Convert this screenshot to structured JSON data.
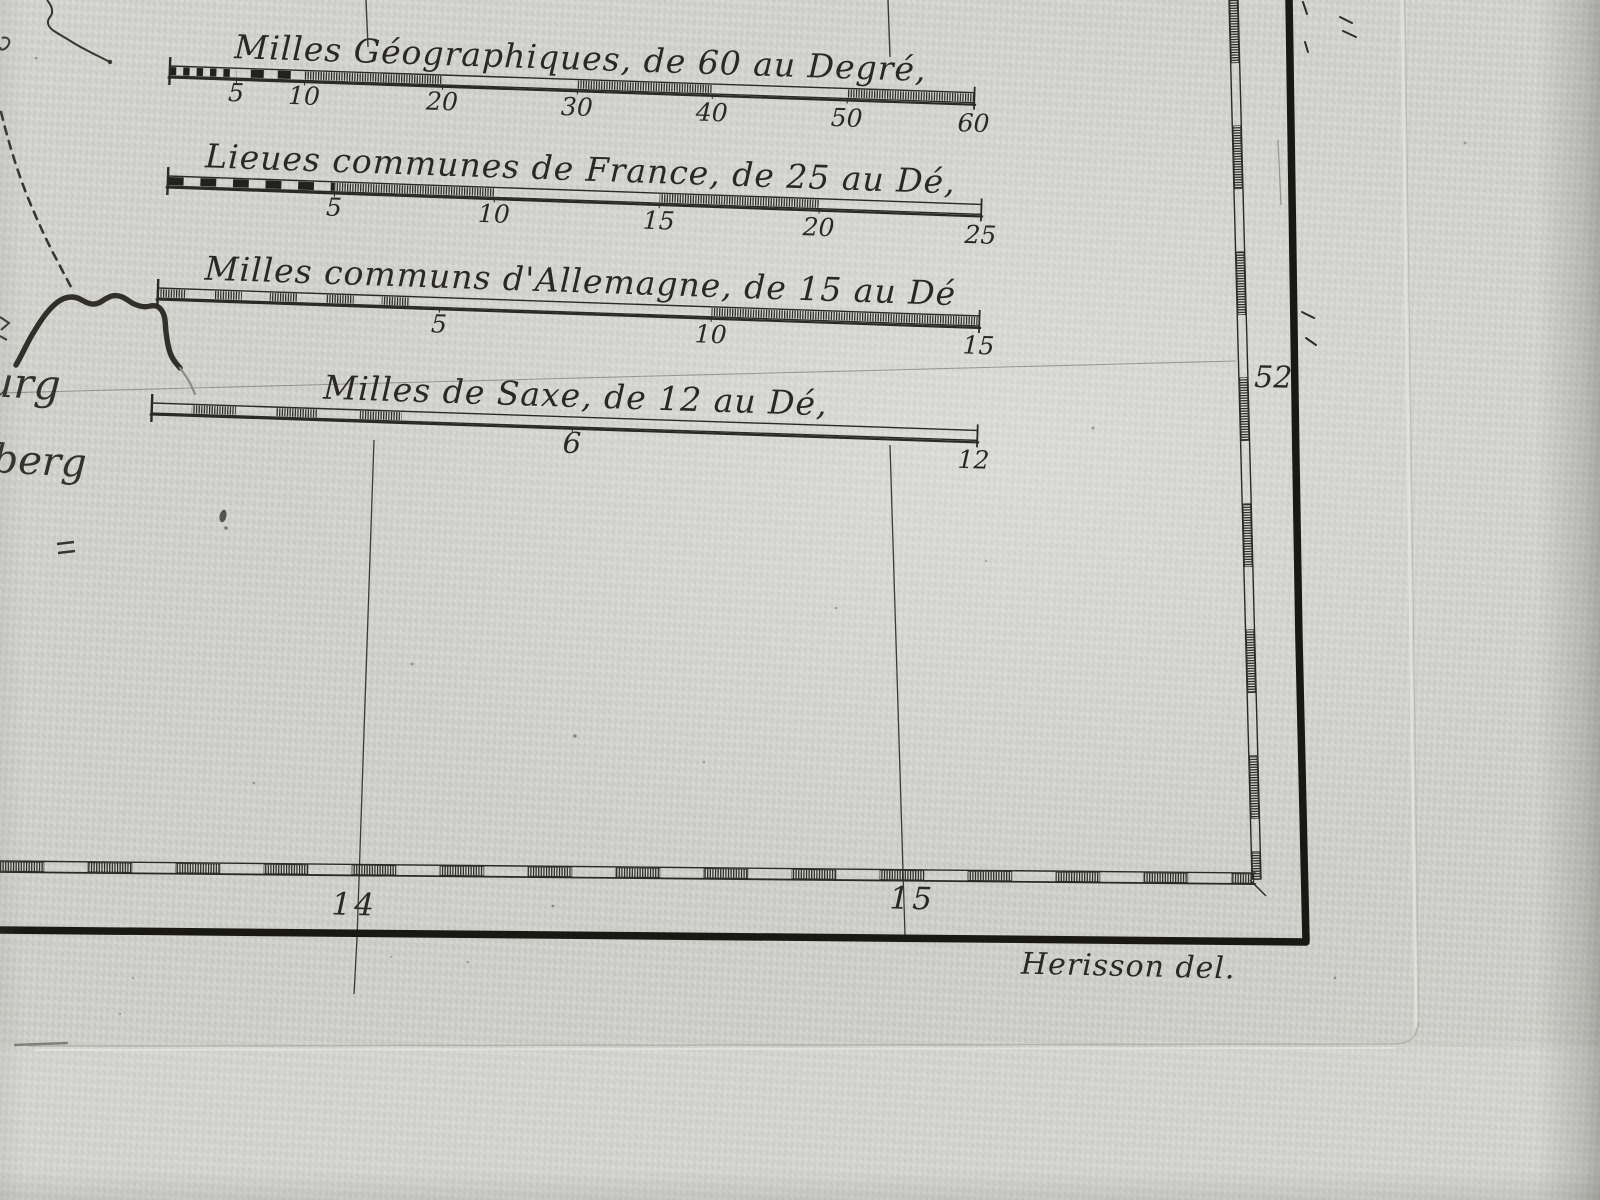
{
  "scale_bars": [
    {
      "title": "Milles Géographiques, de 60 au Degré,",
      "ticks": [
        "5",
        "10",
        "20",
        "30",
        "40",
        "50",
        "60"
      ]
    },
    {
      "title": "Lieues communes de France, de 25 au Dé,",
      "ticks": [
        "5",
        "10",
        "15",
        "20",
        "25"
      ]
    },
    {
      "title": "Milles communs d'Allemagne, de 15 au Dé",
      "ticks": [
        "5",
        "10",
        "15"
      ]
    },
    {
      "title": "Milles de Saxe, de 12 au Dé,",
      "ticks": [
        "6",
        "12"
      ]
    }
  ],
  "graticule": {
    "latitude_label": "52",
    "longitude_labels": [
      "14",
      "15"
    ]
  },
  "place_names": {
    "fragment_1": "urg",
    "fragment_2": "berg"
  },
  "signature": "Herisson del.",
  "colors": {
    "paper": "#d3d4cf",
    "ink": "#26241f",
    "faint_line": "#6b6960"
  }
}
